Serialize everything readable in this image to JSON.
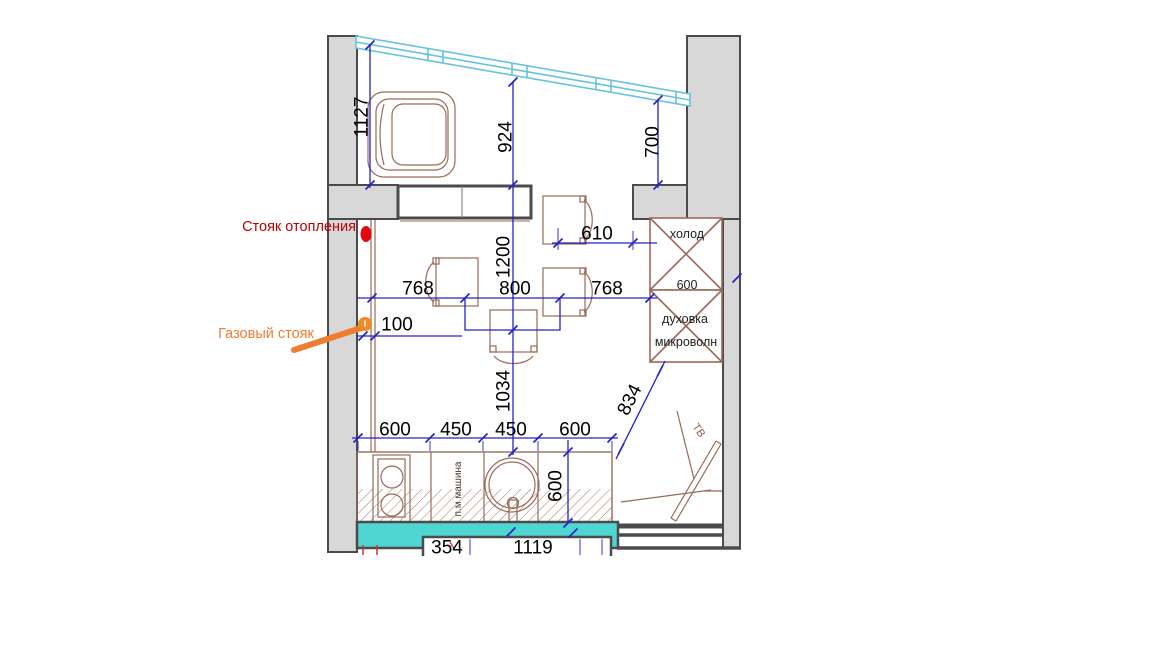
{
  "annotations": {
    "heating_riser": "Стояк отопления",
    "gas_riser": "Газовый стояк"
  },
  "appliances": {
    "fridge": "холод",
    "fridge_size": "600",
    "oven": "духовка",
    "microwave": "микроволн",
    "tv": "ТВ",
    "dishwasher": "п.м машина"
  },
  "dimensions": {
    "window_left": "1127",
    "window_mid": "924",
    "window_right": "700",
    "doorway": "610",
    "left_to_table": "768",
    "table_width": "800",
    "table_to_fridge": "768",
    "gas_offset": "100",
    "table_length": "1200",
    "table_to_counter": "1034",
    "fridge_to_counter": "834",
    "counter_seg1": "600",
    "counter_seg2": "450",
    "counter_seg3": "450",
    "counter_seg4": "600",
    "counter_depth": "600",
    "bottom_seg1": "354",
    "bottom_seg2": "1119"
  },
  "colors": {
    "wall_fill": "#d8d8d8",
    "wall_edge": "#4b4b4b",
    "dimension_blue": "#2323c8",
    "furniture_brown": "#9a6a58",
    "window_blue": "#66c3dd",
    "balcony_teal": "#4fd6d2",
    "heating_red": "#cc0000",
    "gas_orange": "#ed7d31"
  }
}
